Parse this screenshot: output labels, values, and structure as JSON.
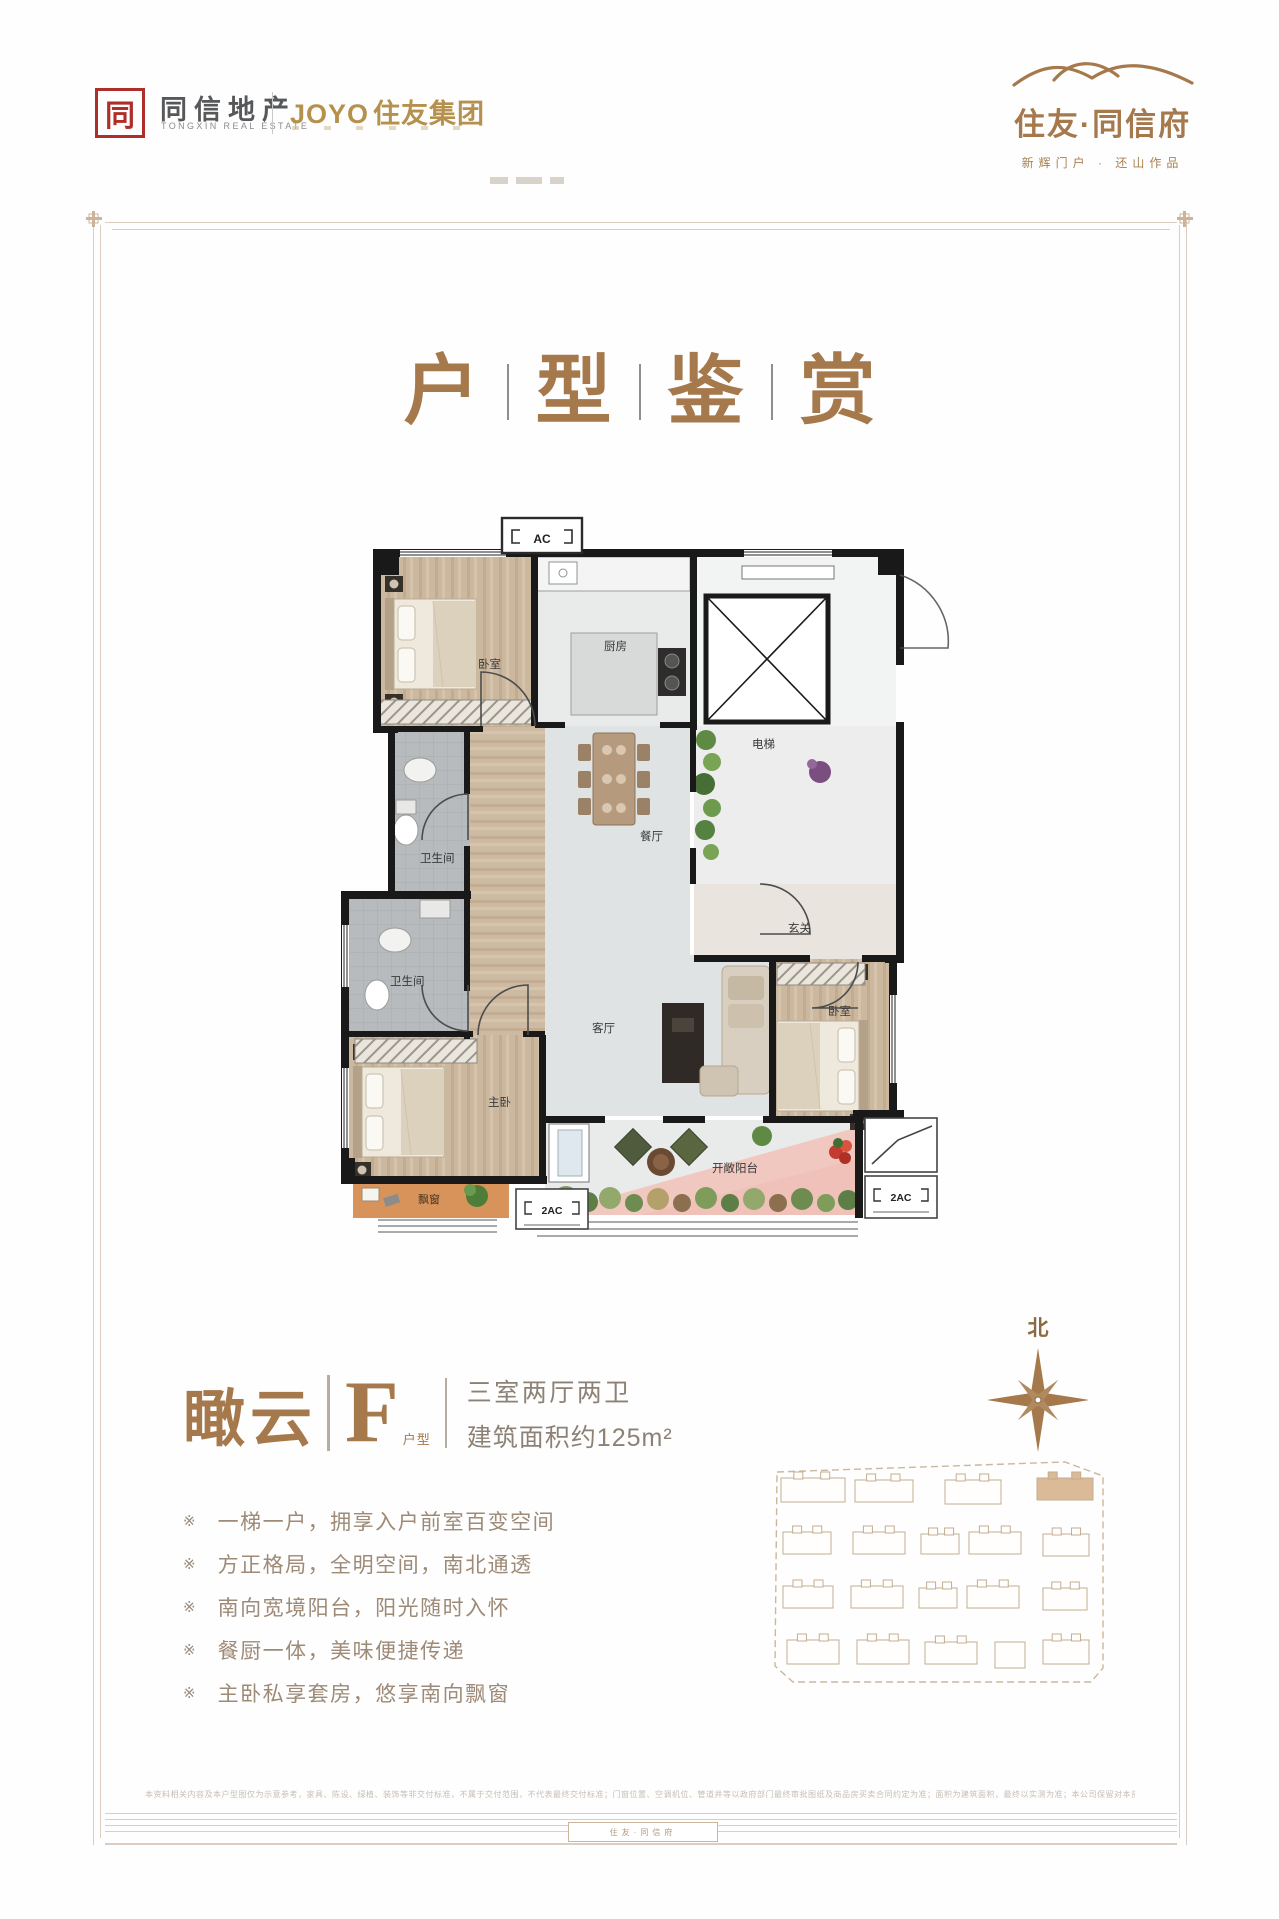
{
  "colors": {
    "accent": "#a5794c",
    "gold": "#b5914d",
    "seal_red": "#ae2f29",
    "feature_text": "#9d8a77",
    "spec_text": "#8d8175",
    "wall": "#191919",
    "wood": "#ccb89f",
    "tile_gray": "#b7bbbd",
    "floor_light": "#e0e3e4",
    "balcony_pink": "#f1c8c0",
    "bay_orange": "#d8935a",
    "frame_tan": "#dbcec1"
  },
  "header": {
    "left": {
      "seal_char": "同",
      "brand": "同信地产",
      "brand_en": "TONGXIN REAL ESTATE",
      "partner_en": "JOYO",
      "partner_cn": "住友集团"
    },
    "right": {
      "name": "住友·同信府",
      "tagline": "新辉门户 · 还山作品"
    }
  },
  "title": {
    "chars": [
      "户",
      "型",
      "鉴",
      "赏"
    ]
  },
  "floorplan": {
    "ac": "AC",
    "ac2_left": "2AC",
    "ac2_right": "2AC",
    "rooms": {
      "bedroom_tl": "卧室",
      "kitchen": "厨房",
      "elevator": "电梯",
      "dining": "餐厅",
      "bath_upper": "卫生间",
      "bath_lower": "卫生间",
      "foyer": "玄关",
      "living": "客厅",
      "master": "主卧",
      "bedroom_r": "卧室",
      "balcony": "开敞阳台",
      "bay": "飘窗"
    }
  },
  "info": {
    "name": "瞰云",
    "type_letter": "F",
    "type_label": "户型",
    "spec_line1": "三室两厅两卫",
    "spec_line2": "建筑面积约125m²"
  },
  "features": {
    "marker": "※",
    "items": [
      "一梯一户，拥享入户前室百变空间",
      "方正格局，全明空间，南北通透",
      "南向宽境阳台，阳光随时入怀",
      "餐厨一体，美味便捷传递",
      "主卧私享套房，悠享南向飘窗"
    ]
  },
  "compass": {
    "north": "北"
  },
  "footer": {
    "disclaimer": "本资料相关内容及本户型图仅为示意参考，家具、陈设、绿植、装饰等非交付标准，不属于交付范围，不代表最终交付标准；门窗位置、空调机位、管道井等以政府部门最终审批图纸及商品房买卖合同约定为准；面积为建筑面积，最终以实测为准；本公司保留对本资料的解释权，敬请留意最新资料。",
    "seal_text": "住友·同信府"
  }
}
